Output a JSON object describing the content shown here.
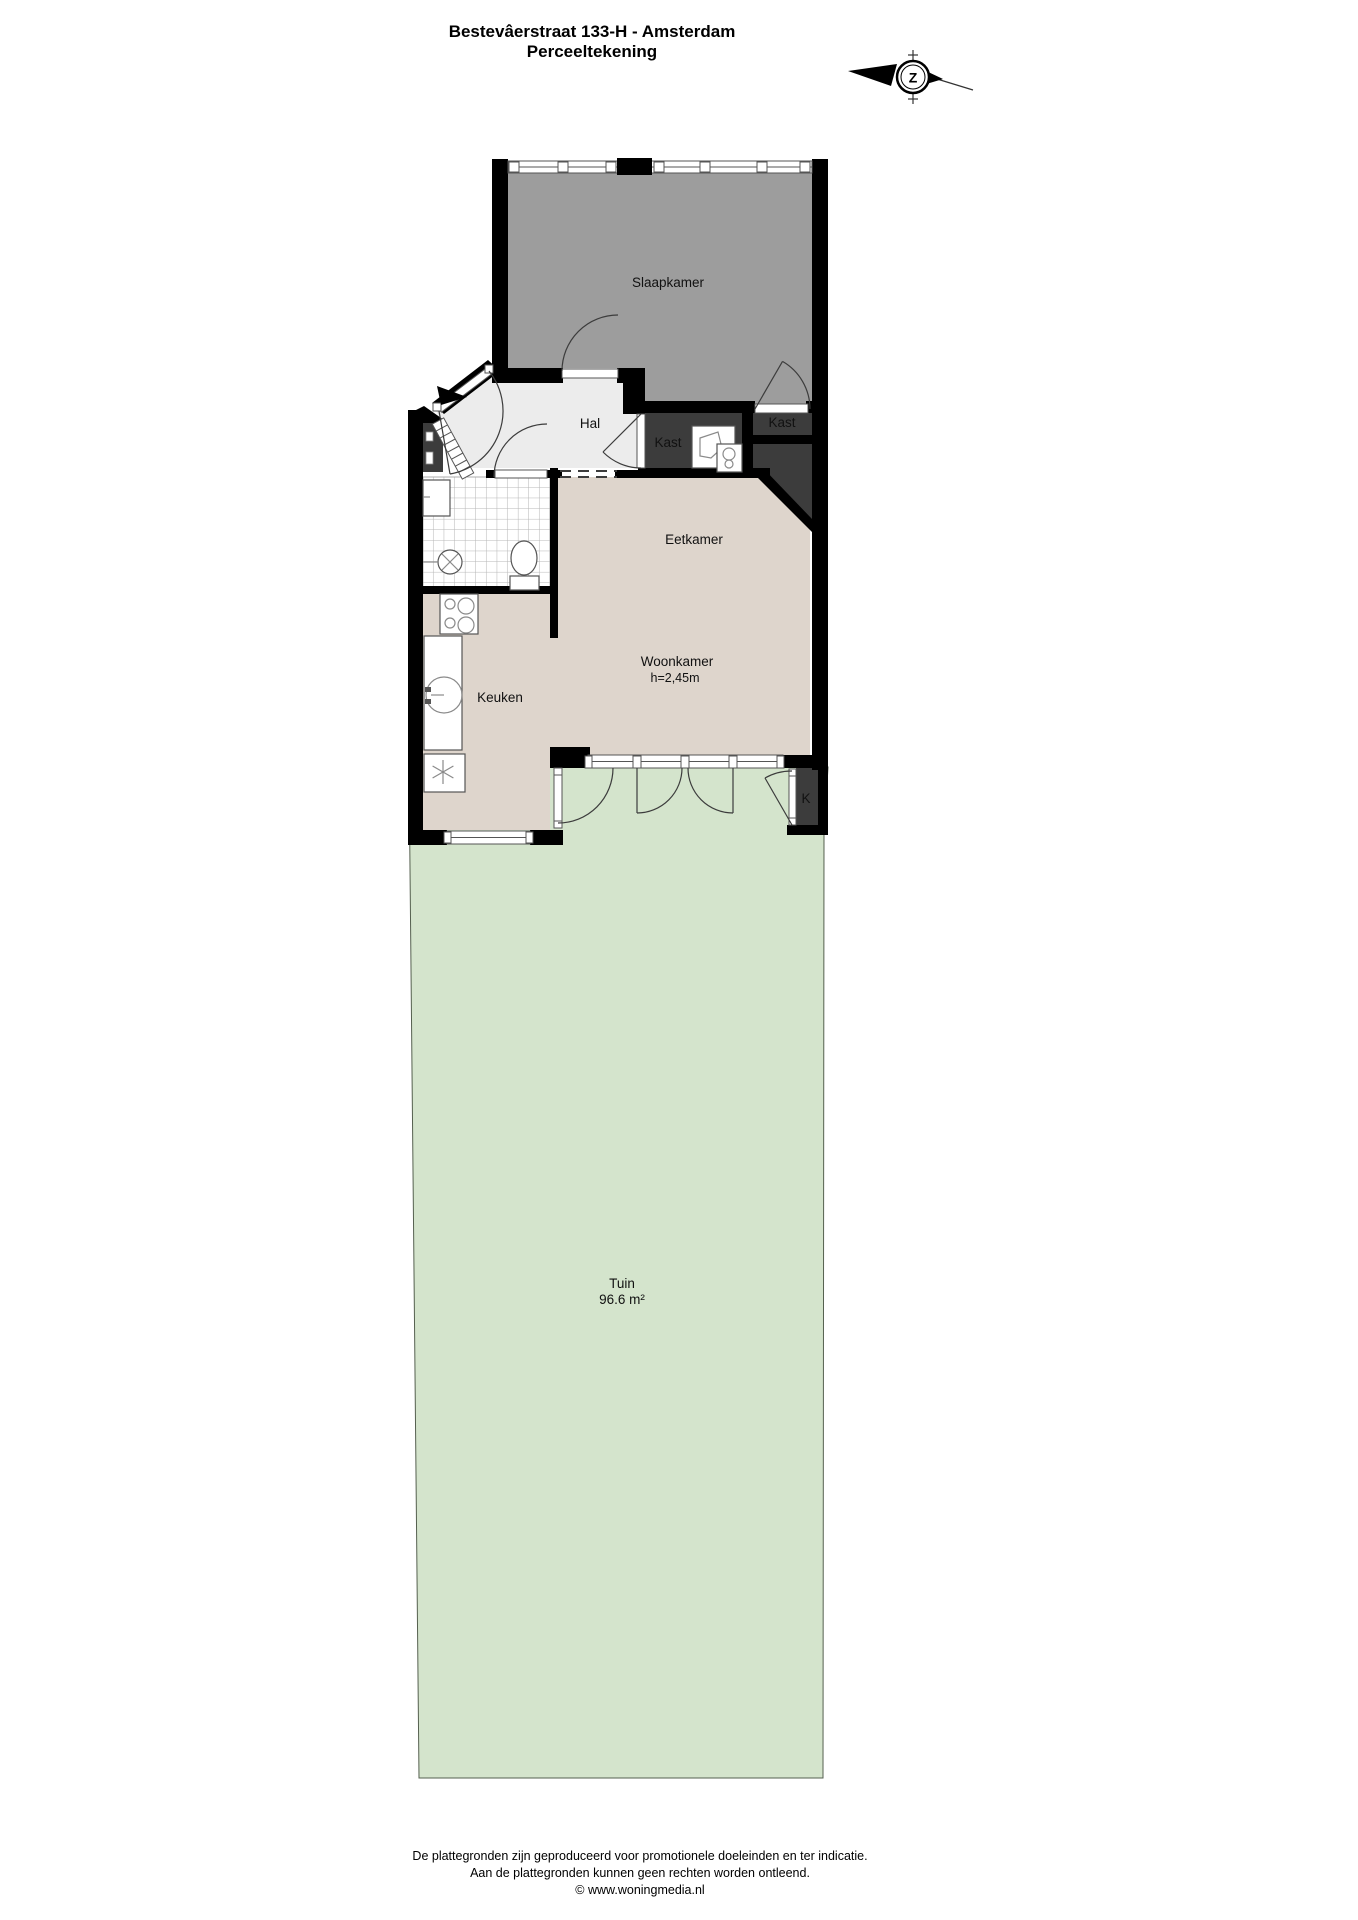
{
  "title": {
    "line1": "Bestevâerstraat 133-H - Amsterdam",
    "line2": "Perceeltekening"
  },
  "compass": {
    "letter": "Z"
  },
  "rooms": {
    "slaapkamer": {
      "label": "Slaapkamer"
    },
    "hal": {
      "label": "Hal"
    },
    "kast1": {
      "label": "Kast"
    },
    "kast2": {
      "label": "Kast"
    },
    "eetkamer": {
      "label": "Eetkamer"
    },
    "woonkamer": {
      "label": "Woonkamer",
      "height": "h=2,45m"
    },
    "keuken": {
      "label": "Keuken"
    },
    "tuin": {
      "label": "Tuin",
      "area": "96.6 m²"
    },
    "kshed": {
      "label": "K"
    }
  },
  "footer": {
    "line1": "De plattegronden zijn geproduceerd voor promotionele doeleinden en ter indicatie.",
    "line2": "Aan de plattegronden kunnen geen rechten worden ontleend.",
    "line3": "© www.woningmedia.nl"
  },
  "colors": {
    "garden": "#d4e4cc",
    "floor_beige": "#ded5cc",
    "bedroom_gray": "#9d9d9d",
    "hall_gray": "#ececec",
    "closet_dark": "#3c3c3c",
    "wall_black": "#000000"
  }
}
